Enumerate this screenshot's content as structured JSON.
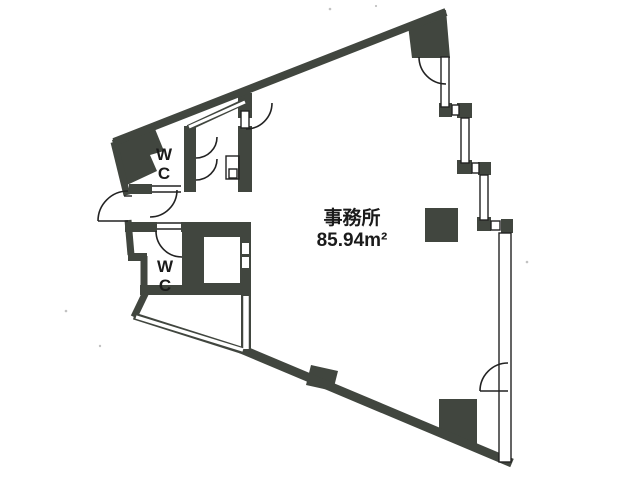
{
  "floorplan": {
    "rooms": {
      "office": {
        "label": "事務所",
        "area": "85.94m²"
      },
      "wc_upper": {
        "w": "W",
        "c": "C"
      },
      "wc_lower": {
        "w": "W",
        "c": "C"
      }
    },
    "colors": {
      "wall": "#41463f",
      "line": "#222222",
      "background": "#ffffff"
    }
  }
}
